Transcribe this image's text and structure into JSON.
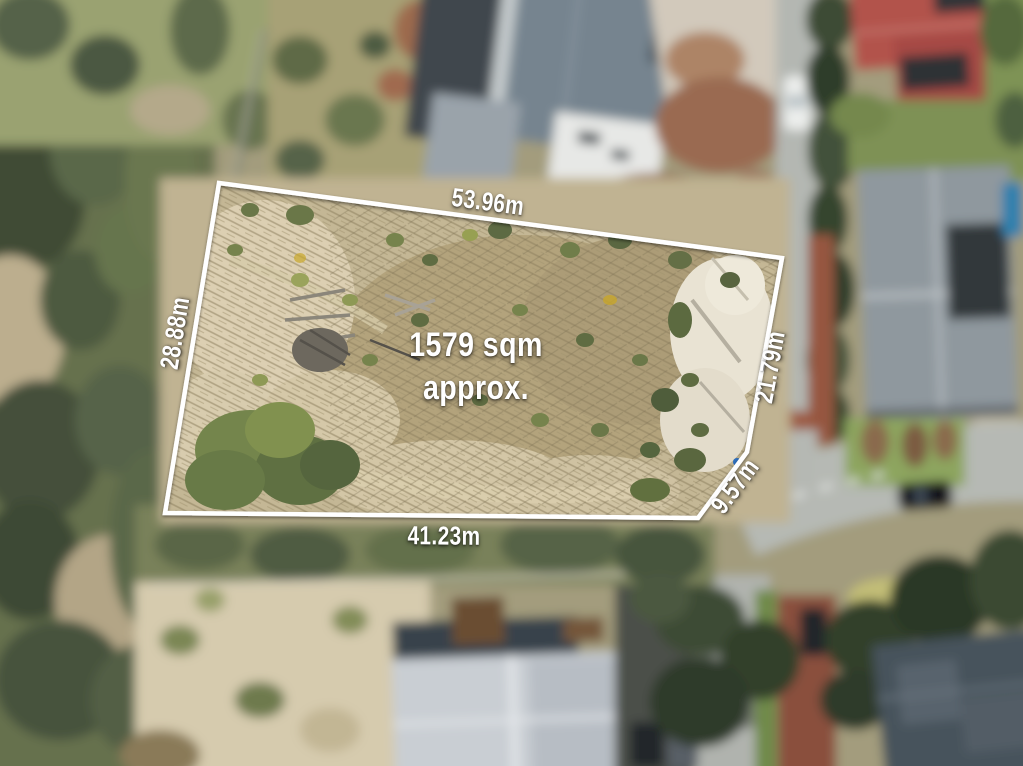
{
  "photo": {
    "kind": "aerial-drone-photo-with-lot-boundary-overlay",
    "subject": "vacant residential land parcel, tilt-shift blurred surroundings"
  },
  "overlay": {
    "area": {
      "line1": "1579 sqm",
      "line2": "approx."
    },
    "dimensions": {
      "top": "53.96m",
      "left": "28.88m",
      "right": "21.79m",
      "corner": "9.57m",
      "bottom": "41.23m"
    },
    "boundary_color": "#ffffff",
    "text_color": "#ffffff"
  },
  "palette": {
    "lot_ground_tan": "#c4b795",
    "sand_light": "#dccfb2",
    "bushland_green": "#5d6848",
    "road_gray": "#b4b7b2",
    "red_path": "#96563f",
    "slate_roof": "#76848f",
    "red_roof": "#b2524c",
    "gray_roof": "#8f989e",
    "light_roof": "#c9ced3",
    "lawn_green": "#7e9154",
    "pool_blue": "#2f80ad"
  }
}
